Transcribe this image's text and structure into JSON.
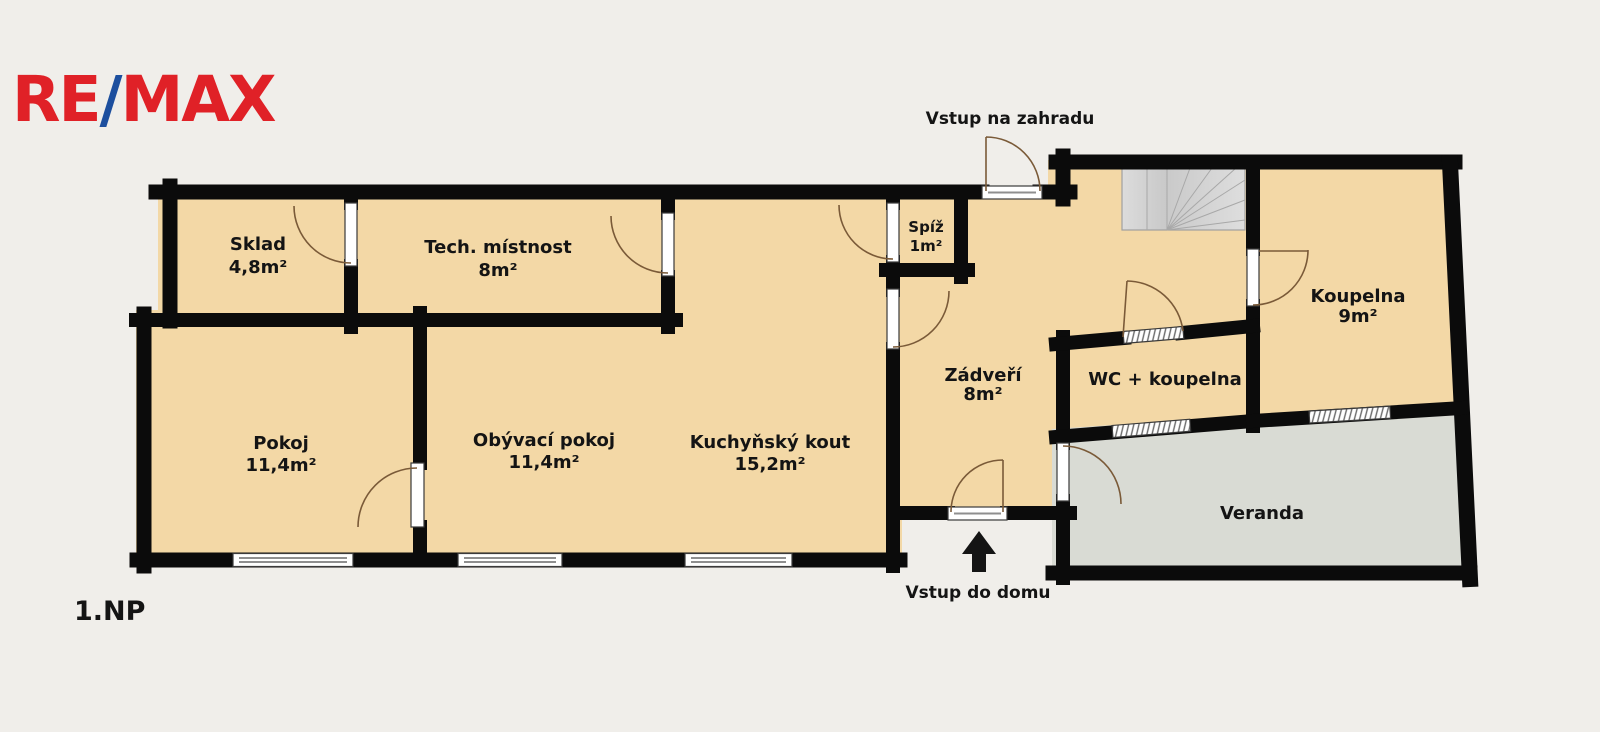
{
  "logo": {
    "part1": "RE",
    "slash": "/",
    "part2": "MAX",
    "red": "#e02127",
    "blue": "#1d4f9e"
  },
  "floor_label": "1.NP",
  "annotations": {
    "garden_entrance": "Vstup na zahradu",
    "house_entrance": "Vstup do domu"
  },
  "rooms": {
    "sklad": {
      "name": "Sklad",
      "area": "4,8m²"
    },
    "tech": {
      "name": "Tech. místnost",
      "area": "8m²"
    },
    "pokoj": {
      "name": "Pokoj",
      "area": "11,4m²"
    },
    "obyvaci": {
      "name": "Obývací pokoj",
      "area": "11,4m²"
    },
    "kuchyn": {
      "name": "Kuchyňský kout",
      "area": "15,2m²"
    },
    "spiz": {
      "name": "Spíž",
      "area": "1m²"
    },
    "zadveri": {
      "name": "Zádveří",
      "area": "8m²"
    },
    "wc": {
      "name": "WC + koupelna",
      "area": ""
    },
    "koupelna": {
      "name": "Koupelna",
      "area": "9m²"
    },
    "veranda": {
      "name": "Veranda",
      "area": ""
    }
  },
  "colors": {
    "background": "#f0eeea",
    "room_fill": "#f3d8a6",
    "veranda_fill": "#d9dbd4",
    "stairs_fill": "#d4d4d4",
    "wall": "#0b0b0b",
    "door_arc": "#7a5a38"
  }
}
